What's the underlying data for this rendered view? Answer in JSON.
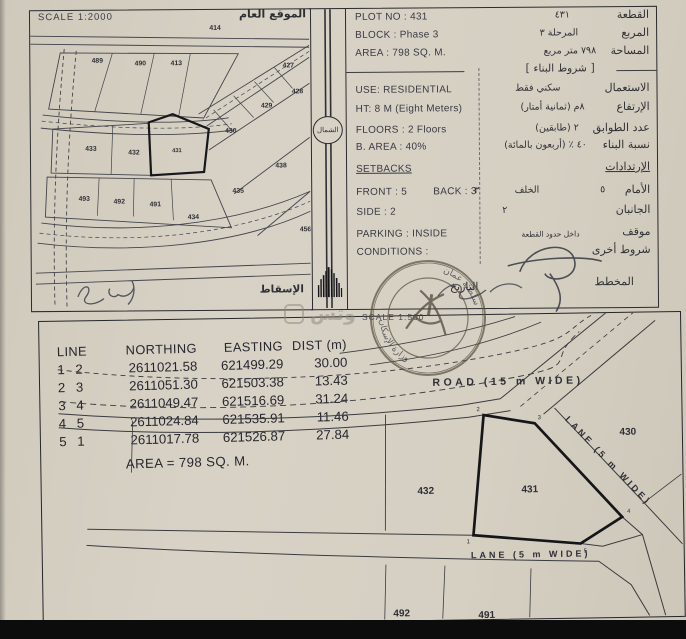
{
  "site_plan": {
    "scale_label": "SCALE 1:2000",
    "title_ar": "الموقع العام",
    "projection_ar": "الإسقاط",
    "plots": {
      "p414": "414",
      "p489": "489",
      "p490": "490",
      "p413": "413",
      "p427": "427",
      "p428": "428",
      "p429": "429",
      "p430": "430",
      "p431": "431",
      "p433": "433",
      "p432": "432",
      "p438": "438",
      "p435": "435",
      "p493": "493",
      "p492": "492",
      "p491": "491",
      "p434": "434",
      "p456": "456"
    }
  },
  "north_label": "الشمال",
  "info": {
    "bracket_title_ar": "شروط البناء",
    "rows": {
      "plot_no_en": "PLOT NO : 431",
      "plot_no_ar_value": "٤٣١",
      "plot_no_ar_label": "القطعة",
      "block_en": "BLOCK :  Phase 3",
      "block_ar_value": "المرحلة ٣",
      "block_ar_label": "المربع",
      "area_en": "AREA :  798 SQ. M.",
      "area_ar_value": "٧٩٨      متر مربع",
      "area_ar_label": "المساحة",
      "use_en": "USE: RESIDENTIAL",
      "use_ar_value": "سكني فقط",
      "use_ar_label": "الاستعمال",
      "ht_en": "HT: 8 M  (Eight Meters)",
      "ht_ar_value": "٨م  (ثمانية أمتار)",
      "ht_ar_label": "الإرتفاع",
      "floors_en": "FLOORS :  2 Floors",
      "floors_ar_value": "٢  (طابقين)",
      "floors_ar_label": "عدد الطوابق",
      "barea_en": "B. AREA :    40%",
      "barea_ar_value": "٤٠ ٪ (أربعون بالمائة)",
      "barea_ar_label": "نسبة البناء",
      "setbacks_en": "SETBACKS",
      "setbacks_ar_label": "الإرتدادات",
      "front_en": "FRONT : 5",
      "back_en": "BACK : 3",
      "front_ar_value": "٥",
      "front_ar_label": "الأمام",
      "back_ar_value": "٣",
      "back_ar_label": "الخلف",
      "side_en": "SIDE :   2",
      "side_ar_value": "٢",
      "side_ar_label": "الجانبان",
      "parking_en": "PARKING : INSIDE",
      "parking_ar_value": "داخل حدود القطعة",
      "parking_ar_label": "موقف",
      "conditions_en": "CONDITIONS :",
      "conditions_ar_label": "شروط أخرى",
      "date_ar_label": "التاريخ",
      "planner_ar_label": "المخطط"
    }
  },
  "coord_table": {
    "headers": [
      "LINE",
      "NORTHING",
      "EASTING",
      "DIST (m)"
    ],
    "rows": [
      {
        "from": "1",
        "to": "2",
        "northing": "2611021.58",
        "easting": "621499.29",
        "dist": "30.00"
      },
      {
        "from": "2",
        "to": "3",
        "northing": "2611051.30",
        "easting": "621503.38",
        "dist": "13.43"
      },
      {
        "from": "3",
        "to": "4",
        "northing": "2611049.47",
        "easting": "621516.69",
        "dist": "31.24"
      },
      {
        "from": "4",
        "to": "5",
        "northing": "2611024.84",
        "easting": "621535.91",
        "dist": "11.46"
      },
      {
        "from": "5",
        "to": "1",
        "northing": "2611017.78",
        "easting": "621526.87",
        "dist": "27.84"
      }
    ],
    "area_total": "AREA = 798 SQ. M."
  },
  "detail_plan": {
    "scale_label": "SCALE 1:500",
    "road_label": "ROAD (15 m  WIDE)",
    "lane_diagonal_label": "LANE (5 m WIDE)",
    "lane_bottom_label": "LANE (5 m  WIDE)",
    "plot_430": "430",
    "plot_431": "431",
    "plot_432": "432",
    "plot_492": "492",
    "plot_491": "491",
    "vertex_labels": [
      "1",
      "2",
      "3",
      "4",
      "5"
    ]
  },
  "watermark_text": "وتس"
}
